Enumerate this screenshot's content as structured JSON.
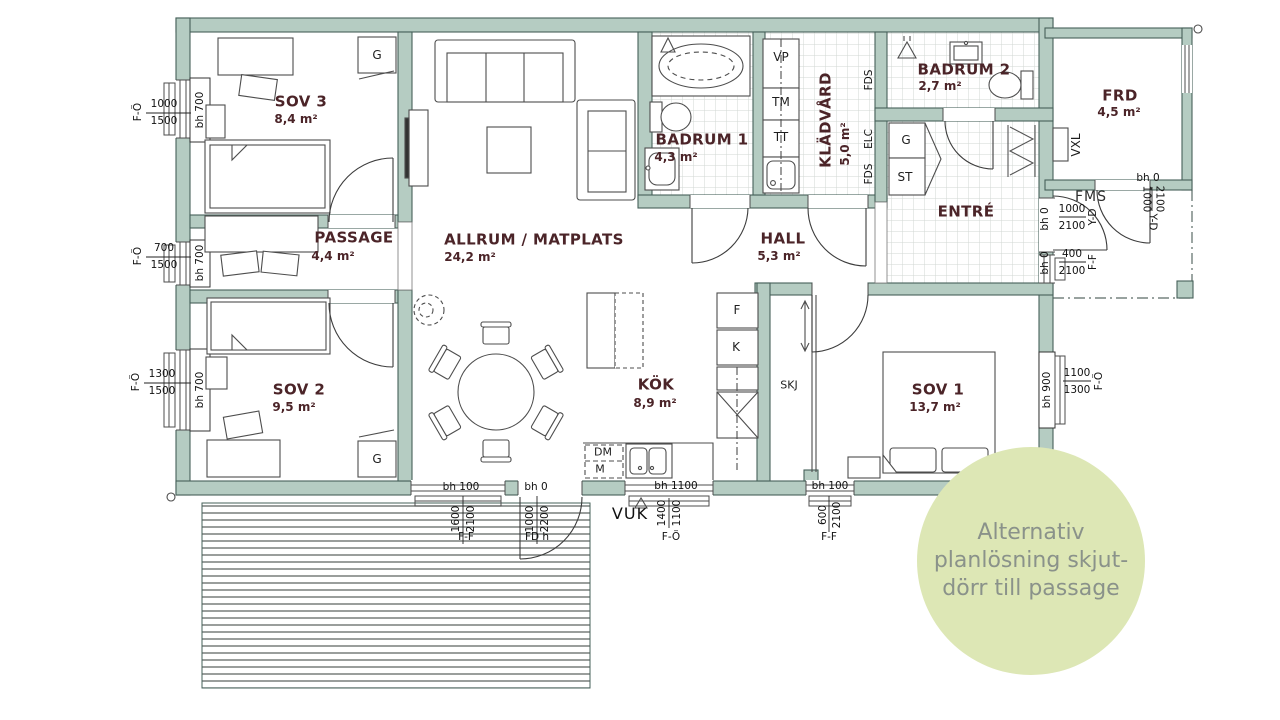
{
  "colors": {
    "wall_fill": "#b5ccc2",
    "wall_outline": "#466059",
    "room_label": "#4b2428",
    "tile_line": "#d2d7d3",
    "callout_fill": "#dde7b5",
    "callout_text": "#8a928a"
  },
  "rooms": {
    "sov3": {
      "name": "SOV 3",
      "area": "8,4 m²"
    },
    "passage": {
      "name": "PASSAGE",
      "area": "4,4 m²"
    },
    "sov2": {
      "name": "SOV 2",
      "area": "9,5 m²"
    },
    "allrum": {
      "name": "ALLRUM / MATPLATS",
      "area": "24,2 m²"
    },
    "badrum1": {
      "name": "BADRUM 1",
      "area": "4,3 m²"
    },
    "kladvard": {
      "name": "KLÄDVÅRD",
      "area": "5,0 m²"
    },
    "badrum2": {
      "name": "BADRUM 2",
      "area": "2,7 m²"
    },
    "hall": {
      "name": "HALL",
      "area": "5,3 m²"
    },
    "entre": {
      "name": "ENTRÉ"
    },
    "kok": {
      "name": "KÖK",
      "area": "8,9 m²"
    },
    "sov1": {
      "name": "SOV 1",
      "area": "13,7 m²"
    },
    "frd": {
      "name": "FRD",
      "area": "4,5 m²"
    }
  },
  "fixtures": {
    "g": "G",
    "st": "ST",
    "vp": "VP",
    "tm": "TM",
    "tt": "TT",
    "f": "F",
    "k": "K",
    "dm": "DM",
    "m": "M",
    "skj": "SKJ",
    "vxl": "VXL",
    "fms": "FMS",
    "vuk": "VUK",
    "fds": "FDS",
    "elc": "ELC"
  },
  "dims": {
    "left": [
      {
        "bh": "bh 700",
        "a": "1000",
        "b": "1500",
        "win": "F-Ö"
      },
      {
        "bh": "bh 700",
        "a": "700",
        "b": "1500",
        "win": "F-Ö"
      },
      {
        "bh": "bh 700",
        "a": "1300",
        "b": "1500",
        "win": "F-Ö"
      }
    ],
    "bottom": [
      {
        "bh": "bh 100",
        "a": "1600",
        "b": "2100",
        "win": "F-F"
      },
      {
        "bh": "bh 0",
        "a": "1000",
        "b": "2200",
        "win": "FD h"
      },
      {
        "bh": "bh 1100",
        "a": "1400",
        "b": "1100",
        "win": "F-Ö"
      },
      {
        "bh": "bh 100",
        "a": "600",
        "b": "2100",
        "win": "F-F"
      }
    ],
    "right": [
      {
        "bh": "bh 900",
        "a": "1100",
        "b": "1300",
        "win": "F-Ö"
      }
    ],
    "porch": [
      {
        "bh": "bh 0",
        "a": "1000",
        "b": "2100",
        "win": "Y-D"
      },
      {
        "bh": "bh 0",
        "a": "400",
        "b": "2100",
        "win": "F-F"
      },
      {
        "bh": "bh 0",
        "a": "1000",
        "b": "2100",
        "win": "Y-D"
      }
    ]
  },
  "callout": {
    "line1": "Alternativ",
    "line2": "planlösning skjut-",
    "line3": "dörr till passage"
  }
}
